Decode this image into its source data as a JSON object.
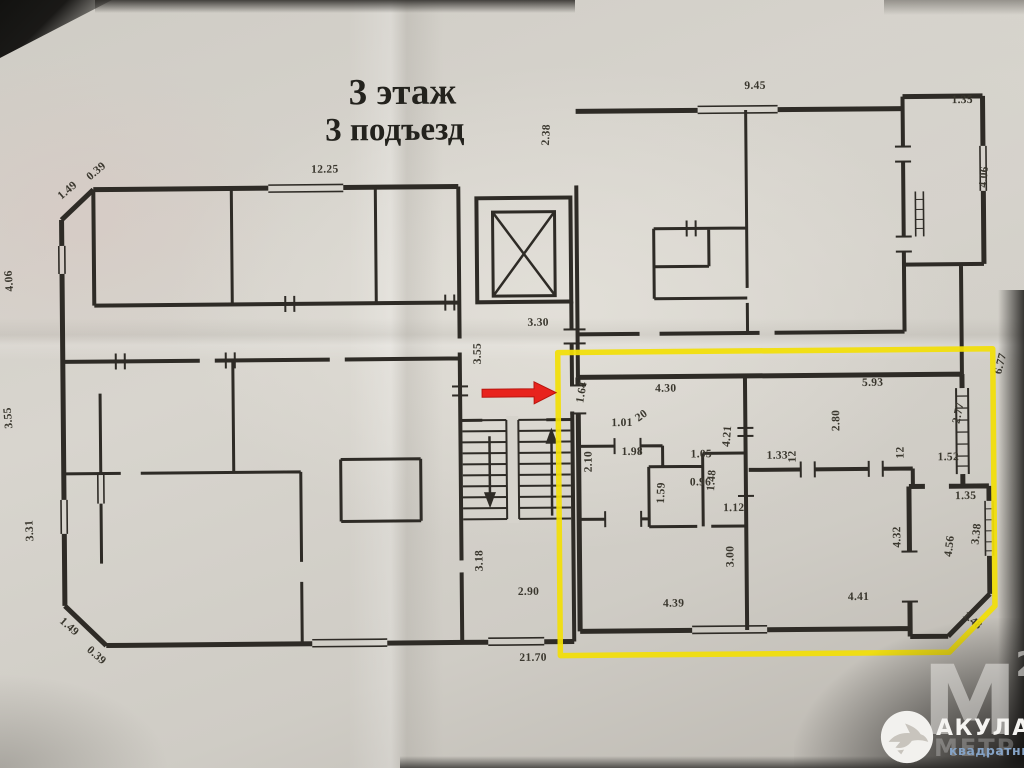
{
  "title": {
    "line1": "3 этаж",
    "line2": "3 подъезд"
  },
  "watermark": {
    "letter": "М",
    "sup": "2",
    "ghost": "МЕТР",
    "brand": "АКУЛА",
    "brand_sub": "квадратный",
    "shark_icon": "shark-logo"
  },
  "colors": {
    "highlight": "#f2df08",
    "arrow": "#e8231d",
    "ink": "#2e2b26",
    "paper": "#d3d0c9",
    "watermark_blue": "#85a3c6"
  },
  "plan": {
    "floor": "3",
    "entrance": "3",
    "dimensions": [
      {
        "t": "12.25",
        "x": 313,
        "y": 171,
        "r": 0
      },
      {
        "t": "9.45",
        "x": 747,
        "y": 91,
        "r": 0
      },
      {
        "t": "1.35",
        "x": 954,
        "y": 107,
        "r": 0
      },
      {
        "t": "2.38",
        "x": 551,
        "y": 146,
        "r": -87
      },
      {
        "t": "4.06",
        "x": 988,
        "y": 192,
        "r": -85
      },
      {
        "t": "1.49",
        "x": 63,
        "y": 196,
        "r": -40
      },
      {
        "t": "0.39",
        "x": 92,
        "y": 177,
        "r": -40
      },
      {
        "t": "4.06",
        "x": 14,
        "y": 287,
        "r": -94
      },
      {
        "t": "3.55",
        "x": 12,
        "y": 424,
        "r": -94
      },
      {
        "t": "3.31",
        "x": 32,
        "y": 537,
        "r": -92
      },
      {
        "t": "1.49",
        "x": 57,
        "y": 618,
        "r": 42
      },
      {
        "t": "0.39",
        "x": 84,
        "y": 647,
        "r": 42
      },
      {
        "t": "21.70",
        "x": 517,
        "y": 661,
        "r": 0
      },
      {
        "t": "3.30",
        "x": 528,
        "y": 326,
        "r": 0
      },
      {
        "t": "3.55",
        "x": 481,
        "y": 364,
        "r": -90
      },
      {
        "t": "3.18",
        "x": 481,
        "y": 571,
        "r": -90
      },
      {
        "t": "2.90",
        "x": 516,
        "y": 595,
        "r": 0
      },
      {
        "t": "1.64",
        "x": 583,
        "y": 404,
        "r": -80
      },
      {
        "t": "2.10",
        "x": 591,
        "y": 473,
        "r": -90
      },
      {
        "t": "1.01",
        "x": 611,
        "y": 427,
        "r": 0
      },
      {
        "t": "20",
        "x": 638,
        "y": 423,
        "r": -35
      },
      {
        "t": "1.98",
        "x": 621,
        "y": 456,
        "r": 0
      },
      {
        "t": "1.05",
        "x": 690,
        "y": 459,
        "r": 0
      },
      {
        "t": "0.96",
        "x": 689,
        "y": 487,
        "r": 0
      },
      {
        "t": "1.59",
        "x": 663,
        "y": 505,
        "r": -88
      },
      {
        "t": "1.48",
        "x": 713,
        "y": 493,
        "r": -85
      },
      {
        "t": "1.12",
        "x": 722,
        "y": 513,
        "r": 0
      },
      {
        "t": "4.30",
        "x": 655,
        "y": 393,
        "r": 0
      },
      {
        "t": "4.21",
        "x": 729,
        "y": 449,
        "r": -85
      },
      {
        "t": "5.93",
        "x": 862,
        "y": 389,
        "r": 0
      },
      {
        "t": "2.80",
        "x": 839,
        "y": 434,
        "r": -90
      },
      {
        "t": "2.77",
        "x": 959,
        "y": 428,
        "r": -78
      },
      {
        "t": "1.33",
        "x": 766,
        "y": 461,
        "r": 0
      },
      {
        "t": "12",
        "x": 795,
        "y": 465,
        "r": -90
      },
      {
        "t": "12",
        "x": 903,
        "y": 462,
        "r": -90
      },
      {
        "t": "1.52",
        "x": 937,
        "y": 464,
        "r": 0
      },
      {
        "t": "6.77",
        "x": 1001,
        "y": 379,
        "r": -75
      },
      {
        "t": "1.35",
        "x": 954,
        "y": 503,
        "r": 0
      },
      {
        "t": "3.38",
        "x": 977,
        "y": 549,
        "r": -83
      },
      {
        "t": "4.56",
        "x": 950,
        "y": 561,
        "r": -83
      },
      {
        "t": "4.32",
        "x": 899,
        "y": 551,
        "r": -90
      },
      {
        "t": "3.00",
        "x": 732,
        "y": 569,
        "r": -90
      },
      {
        "t": "4.39",
        "x": 661,
        "y": 608,
        "r": 0
      },
      {
        "t": "4.41",
        "x": 846,
        "y": 603,
        "r": 0
      },
      {
        "t": "1.48",
        "x": 960,
        "y": 620,
        "r": 40
      }
    ]
  }
}
